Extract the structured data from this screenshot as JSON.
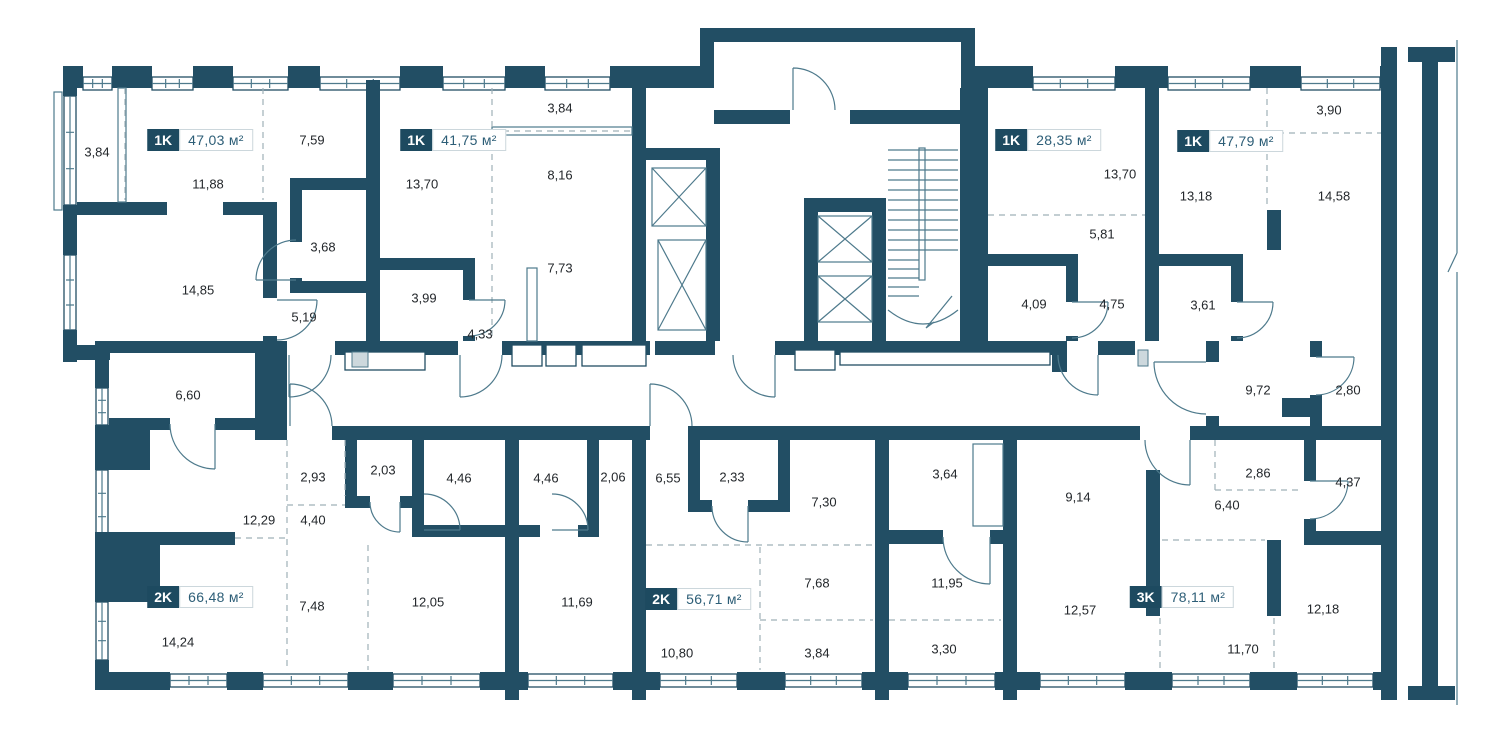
{
  "floor_plan": {
    "unit": "м²",
    "colors": {
      "wall": "#224E64",
      "line": "#4E7A8C",
      "dash": "#9FB0B8",
      "text": "#23272B",
      "badge_bg": "#1D4A60",
      "badge_text": "#FFFFFF",
      "area_text": "#2D5E77",
      "area_border": "#CCD7DC"
    },
    "apartments": [
      {
        "type": "1K",
        "area": "47,03",
        "x": 200,
        "y": 140
      },
      {
        "type": "1K",
        "area": "41,75",
        "x": 453,
        "y": 140
      },
      {
        "type": "1K",
        "area": "28,35",
        "x": 1048,
        "y": 140
      },
      {
        "type": "1K",
        "area": "47,79",
        "x": 1230,
        "y": 141
      },
      {
        "type": "2K",
        "area": "66,48",
        "x": 200,
        "y": 597
      },
      {
        "type": "2K",
        "area": "56,71",
        "x": 698,
        "y": 599
      },
      {
        "type": "3K",
        "area": "78,11",
        "x": 1182,
        "y": 597
      }
    ],
    "room_areas": [
      {
        "v": "3,84",
        "x": 97,
        "y": 152
      },
      {
        "v": "7,59",
        "x": 312,
        "y": 140
      },
      {
        "v": "11,88",
        "x": 208,
        "y": 184
      },
      {
        "v": "14,85",
        "x": 198,
        "y": 290
      },
      {
        "v": "3,68",
        "x": 323,
        "y": 247
      },
      {
        "v": "5,19",
        "x": 304,
        "y": 317
      },
      {
        "v": "6,60",
        "x": 188,
        "y": 395
      },
      {
        "v": "13,70",
        "x": 422,
        "y": 184
      },
      {
        "v": "3,84",
        "x": 560,
        "y": 108
      },
      {
        "v": "8,16",
        "x": 560,
        "y": 175
      },
      {
        "v": "7,73",
        "x": 560,
        "y": 268
      },
      {
        "v": "3,99",
        "x": 424,
        "y": 298
      },
      {
        "v": "4,33",
        "x": 480,
        "y": 334
      },
      {
        "v": "13,70",
        "x": 1120,
        "y": 174
      },
      {
        "v": "5,81",
        "x": 1102,
        "y": 234
      },
      {
        "v": "4,09",
        "x": 1034,
        "y": 304
      },
      {
        "v": "4,75",
        "x": 1112,
        "y": 304
      },
      {
        "v": "3,90",
        "x": 1329,
        "y": 110
      },
      {
        "v": "13,18",
        "x": 1196,
        "y": 196
      },
      {
        "v": "14,58",
        "x": 1334,
        "y": 196
      },
      {
        "v": "3,61",
        "x": 1203,
        "y": 305
      },
      {
        "v": "9,72",
        "x": 1258,
        "y": 390
      },
      {
        "v": "2,80",
        "x": 1348,
        "y": 390
      },
      {
        "v": "2,93",
        "x": 313,
        "y": 477
      },
      {
        "v": "2,03",
        "x": 383,
        "y": 470
      },
      {
        "v": "12,29",
        "x": 259,
        "y": 520
      },
      {
        "v": "4,40",
        "x": 313,
        "y": 520
      },
      {
        "v": "4,46",
        "x": 459,
        "y": 478
      },
      {
        "v": "4,46",
        "x": 546,
        "y": 478
      },
      {
        "v": "2,06",
        "x": 613,
        "y": 477
      },
      {
        "v": "6,55",
        "x": 668,
        "y": 478
      },
      {
        "v": "2,33",
        "x": 732,
        "y": 477
      },
      {
        "v": "7,30",
        "x": 824,
        "y": 502
      },
      {
        "v": "3,64",
        "x": 945,
        "y": 474
      },
      {
        "v": "9,14",
        "x": 1078,
        "y": 497
      },
      {
        "v": "2,86",
        "x": 1258,
        "y": 473
      },
      {
        "v": "4,37",
        "x": 1348,
        "y": 482
      },
      {
        "v": "6,40",
        "x": 1227,
        "y": 505
      },
      {
        "v": "14,24",
        "x": 178,
        "y": 642
      },
      {
        "v": "7,48",
        "x": 312,
        "y": 606
      },
      {
        "v": "12,05",
        "x": 428,
        "y": 602
      },
      {
        "v": "11,69",
        "x": 577,
        "y": 602
      },
      {
        "v": "10,80",
        "x": 677,
        "y": 653
      },
      {
        "v": "7,68",
        "x": 817,
        "y": 583
      },
      {
        "v": "3,84",
        "x": 817,
        "y": 653
      },
      {
        "v": "11,95",
        "x": 947,
        "y": 583
      },
      {
        "v": "3,30",
        "x": 944,
        "y": 649
      },
      {
        "v": "12,57",
        "x": 1080,
        "y": 610
      },
      {
        "v": "11,70",
        "x": 1243,
        "y": 649
      },
      {
        "v": "12,18",
        "x": 1323,
        "y": 609
      }
    ]
  }
}
